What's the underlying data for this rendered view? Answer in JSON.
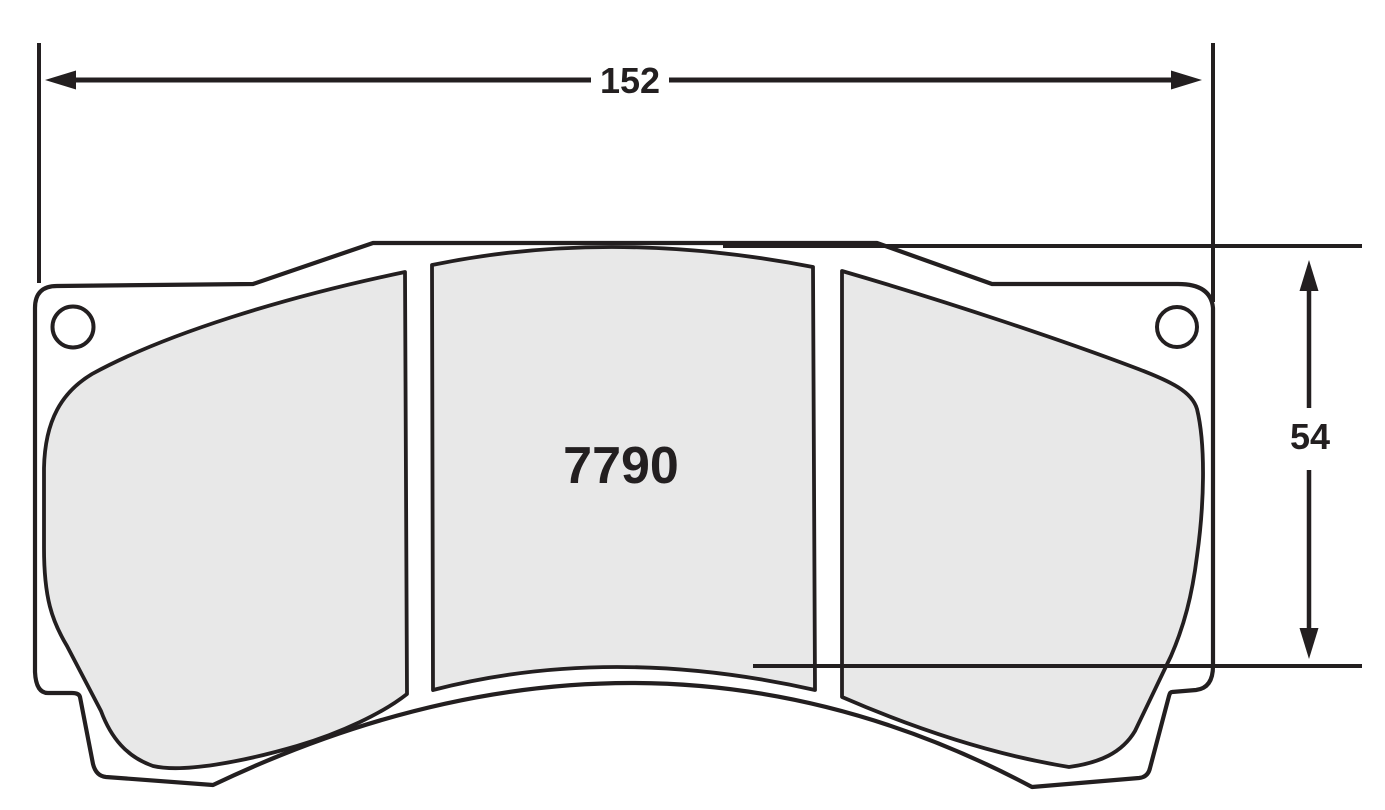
{
  "drawing": {
    "part_number": "7790",
    "dimensions": {
      "width": {
        "value": "152"
      },
      "height": {
        "value": "54"
      }
    },
    "colors": {
      "background": "#ffffff",
      "line": "#231f20",
      "pad_fill": "#e8e8e8",
      "plate_fill": "#ffffff"
    }
  }
}
